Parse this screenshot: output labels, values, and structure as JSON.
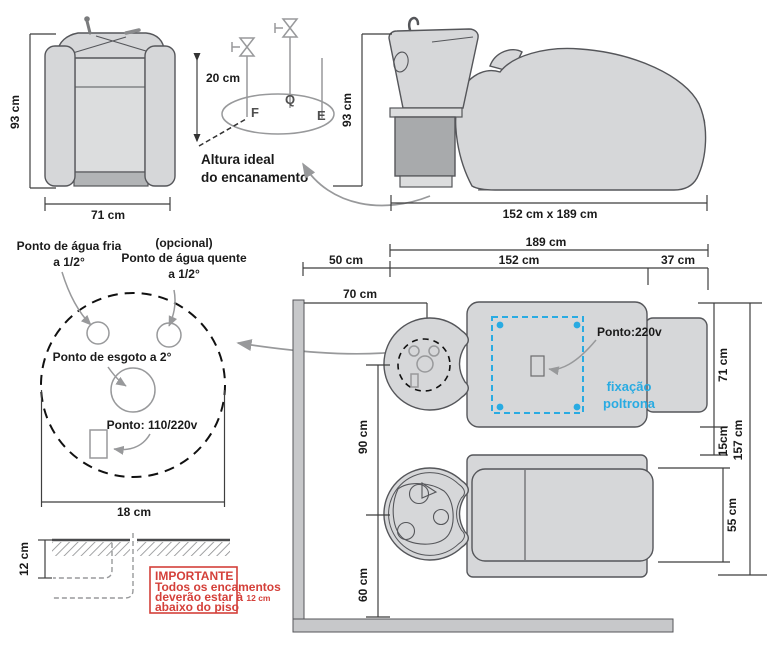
{
  "front_view": {
    "height": "93 cm",
    "width": "71 cm"
  },
  "plumbing_detail": {
    "height": "20 cm",
    "cold_label": "F",
    "hot_label": "Q",
    "drain_label": "E",
    "caption_line1": "Altura ideal",
    "caption_line2": "do encanamento"
  },
  "side_view": {
    "height": "93 cm",
    "footprint": "152 cm x 189 cm"
  },
  "floor_detail": {
    "cold_line1": "Ponto de água fria",
    "cold_line2": "a 1/2°",
    "optional": "(opcional)",
    "hot_line1": "Ponto de água quente",
    "hot_line2": "a 1/2°",
    "drain": "Ponto de esgoto a 2°",
    "power": "Ponto: 110/220v",
    "width": "18 cm"
  },
  "cross_section": {
    "depth": "12 cm",
    "warning": {
      "title": "IMPORTANTE",
      "line1": "Todos os encamentos",
      "line2_normal": "deverão estar à ",
      "line2_bold": "12 cm",
      "line3": "abaixo do piso"
    }
  },
  "floor_plan": {
    "dim_189": "189 cm",
    "dim_152": "152 cm",
    "dim_50": "50 cm",
    "dim_37": "37 cm",
    "dim_70": "70 cm",
    "dim_90": "90 cm",
    "dim_60": "60 cm",
    "dim_71": "71 cm",
    "dim_15": "15cm",
    "dim_55": "55 cm",
    "dim_157": "157 cm",
    "power": "Ponto:220v",
    "fixation_line1": "fixação",
    "fixation_line2": "poltrona"
  },
  "colors": {
    "accent_blue": "#29abe2",
    "warning_red": "#d4403a",
    "fill_light": "#d6d7d9",
    "fill_mid": "#a8aaac",
    "wall_gray": "#c7c8ca",
    "stroke_dark": "#55565a",
    "line_gray": "#98999b",
    "text": "#1a1a1a"
  }
}
